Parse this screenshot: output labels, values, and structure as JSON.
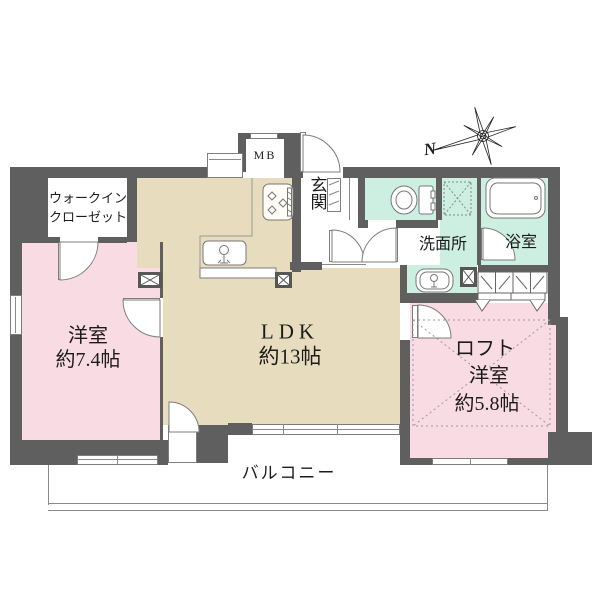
{
  "plan": {
    "type": "apartment-floor-plan",
    "compass": {
      "north_label": "N"
    },
    "rooms": {
      "walk_in_closet": {
        "label_lines": [
          "ウォークイン",
          "クローゼット"
        ]
      },
      "bedroom_west": {
        "name": "洋室",
        "size": "約7.4帖"
      },
      "ldk": {
        "name": "LDK",
        "size": "約13帖"
      },
      "entrance": {
        "name": "玄関"
      },
      "washroom": {
        "name": "洗面所"
      },
      "bathroom": {
        "name": "浴室"
      },
      "bedroom_east": {
        "loft_label": "ロフト",
        "name": "洋室",
        "size": "約5.8帖"
      },
      "balcony": {
        "name": "バルコニー"
      },
      "meter_box": {
        "name": "MB"
      }
    },
    "colors": {
      "wall": "#5f5f5f",
      "bedroom_fill": "#f9dce3",
      "ldk_fill": "#e8dcbe",
      "wet_area_fill": "#ccefe2",
      "outline": "#7d7d7d",
      "text": "#1c1c1c",
      "background": "#ffffff"
    },
    "icons": {
      "compass": "compass-rose-icon",
      "toilet": "toilet-icon",
      "bathtub": "bathtub-icon",
      "washing_machine": "washing-machine-space-icon",
      "vanity_sink": "vanity-sink-icon",
      "kitchen_sink": "kitchen-sink-icon",
      "stove": "stove-icon",
      "pillar": "pillar-x-icon",
      "loft_area": "loft-dashed-area-icon",
      "closet": "folding-closet-icon",
      "shoe_cabinet": "shoe-cabinet-icon",
      "door": "door-swing-icon",
      "window": "window-icon"
    }
  }
}
